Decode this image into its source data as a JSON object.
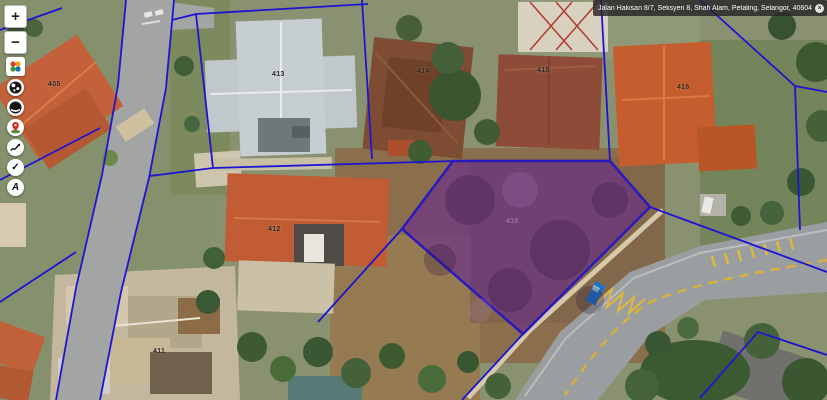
{
  "address_bar": {
    "text": "Jalan Hakisan 8/7, Seksyen 8, Shah Alam, Petaling, Selangor, 40604, M",
    "close_glyph": "×"
  },
  "toolbar": {
    "zoom_in_label": "+",
    "zoom_out_label": "−",
    "buttons": [
      {
        "name": "basemap-logo-button",
        "icon": "colorful-logo"
      },
      {
        "name": "globe-button",
        "icon": "globe"
      },
      {
        "name": "dark-globe-button",
        "icon": "dark-globe"
      },
      {
        "name": "location-marker-button",
        "icon": "red-pin"
      },
      {
        "name": "sketch-button",
        "icon": "squiggle"
      },
      {
        "name": "select-button",
        "icon": "check",
        "glyph": "✓"
      },
      {
        "name": "label-button",
        "icon": "letter-a",
        "glyph": "A"
      }
    ]
  },
  "parcels": {
    "boundary_color": "#1e14d2",
    "highlight_fill": "#68288c",
    "labels": [
      {
        "id": "405"
      },
      {
        "id": "413"
      },
      {
        "id": "414"
      },
      {
        "id": "415"
      },
      {
        "id": "416"
      },
      {
        "id": "412"
      },
      {
        "id": "411"
      },
      {
        "id": "410"
      }
    ]
  },
  "road": {
    "marking_color": "#dfb83e"
  }
}
